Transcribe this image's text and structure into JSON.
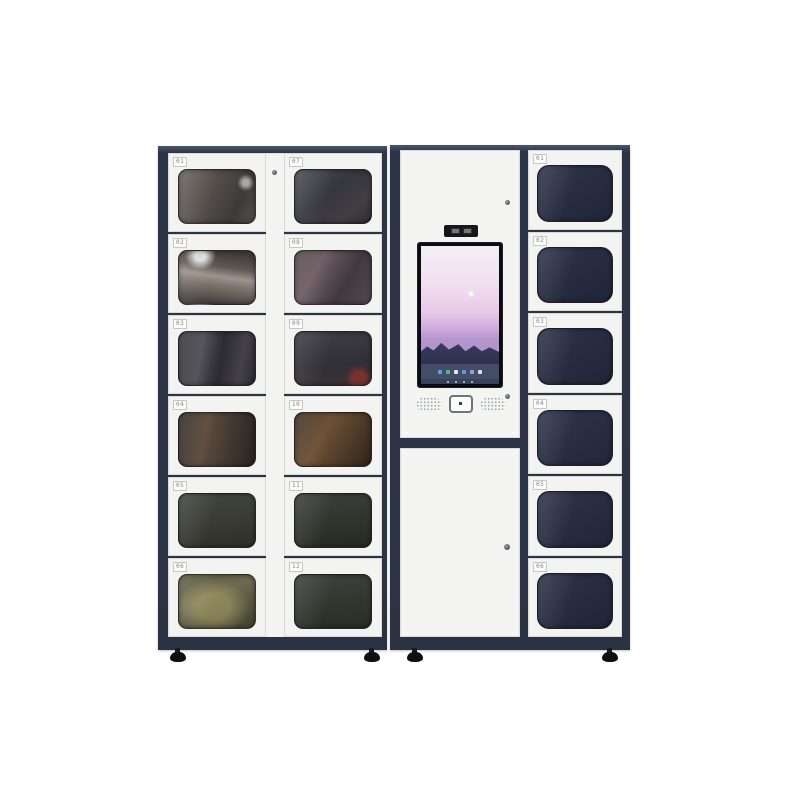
{
  "scene": {
    "description": "Smart locker vending machine: two-column glass-door locker cabinet, central touchscreen kiosk tower, and right locker column",
    "background": "#ffffff"
  },
  "colors": {
    "frame": "#2c3547",
    "frame_edge": "#4a5669",
    "door": "#f3f3f1",
    "door_border": "#d9d9d6",
    "label_text": "#85888e",
    "screen_bezel": "#0b0c10",
    "hardware": "#4b515b"
  },
  "left_unit": {
    "column_a": {
      "lockers": [
        {
          "label": "01",
          "window": "radial-gradient(circle at 88% 24%, rgba(255,255,255,0.55) 0 4%, rgba(255,255,255,0) 11%), linear-gradient(115deg, #6a625e 0%, #524c49 45%, #3d3a38 75%, #57504b 100%)"
        },
        {
          "label": "02",
          "window": "radial-gradient(ellipse at 28% 10%, rgba(255,255,255,0.8) 0 7%, rgba(255,255,255,0) 20%), linear-gradient(8deg, #474340 10%, #7b726d 38%, #9c948c 52%, #5f5753 68%, #403c39 92%)"
        },
        {
          "label": "03",
          "window": "linear-gradient(100deg, #35343a 0%, #504e55 30%, #2c2b31 55%, #45424a 80%, #2a292f 100%)"
        },
        {
          "label": "04",
          "window": "linear-gradient(100deg, #2f2a27 0%, #5d4b3c 35%, #413730 68%, #272321 100%)"
        },
        {
          "label": "05",
          "window": "linear-gradient(175deg, #43453f 0%, #383a33 55%, #2d2f28 100%)"
        },
        {
          "label": "06",
          "window": "radial-gradient(ellipse at 45% 60%, rgba(193,178,112,0.45) 0 28%, rgba(0,0,0,0) 62%), linear-gradient(160deg, #5d5b45 0%, #6b6950 40%, #4e4d38 80%, #434231 100%)"
        }
      ]
    },
    "column_b": {
      "lockers": [
        {
          "label": "07",
          "window": "linear-gradient(140deg, #4c4c56 0%, #36363e 45%, #423e44 75%, #303036 100%)"
        },
        {
          "label": "08",
          "window": "linear-gradient(120deg, #514549 0%, #6d5c62 30%, #413941 65%, #534a50 100%)"
        },
        {
          "label": "09",
          "window": "radial-gradient(circle at 84% 88%, rgba(164,52,40,0.6) 0 8%, rgba(0,0,0,0) 17%), linear-gradient(175deg, #3e3c44 0%, #312f37 60%, #3c3136 100%)"
        },
        {
          "label": "10",
          "window": "linear-gradient(120deg, #3b2d23 0%, #6c5033 38%, #4c3a28 70%, #2f2419 100%)"
        },
        {
          "label": "11",
          "window": "linear-gradient(175deg, #3c3e3a 0%, #31332d 55%, #272922 100%)"
        },
        {
          "label": "12",
          "window": "linear-gradient(175deg, #3e403c 0%, #33352f 55%, #2a2c26 100%)"
        }
      ]
    }
  },
  "kiosk": {
    "camera_module": {
      "slots": 2
    },
    "screen": {
      "sky": "linear-gradient(180deg, #f5eff4 0%, #f0dff0 28%, #e7c9e9 48%, #cfaadd 60%, #b394cd 68%)",
      "sun_color": "#ffffff",
      "mountains": "linear-gradient(180deg, #41446b 0%, #343759 60%, #2e3150 100%)",
      "taskbar_bg": "#434d68",
      "taskbar_icons": [
        "#58a6e0",
        "#43bd8b",
        "#e8eaee",
        "#6296e2",
        "#9aa3b8",
        "#dfe2e8"
      ],
      "navbar_bg": "#38415a",
      "nav_dots": [
        "#c7cdd9",
        "#c7cdd9",
        "#c7cdd9",
        "#c7cdd9"
      ]
    }
  },
  "right_column": {
    "lockers": [
      {
        "label": "01",
        "window": "linear-gradient(150deg, #30354a 0%, #272c41 55%, #21263b 100%)"
      },
      {
        "label": "02",
        "window": "linear-gradient(150deg, #2f3448 0%, #262b3f 55%, #20253a 100%)"
      },
      {
        "label": "03",
        "window": "linear-gradient(150deg, #2e3347 0%, #262b3f 55%, #21263a 100%)"
      },
      {
        "label": "04",
        "window": "linear-gradient(150deg, #30354a 0%, #282d42 55%, #22273c 100%)"
      },
      {
        "label": "05",
        "window": "linear-gradient(150deg, #2f3448 0%, #272c40 55%, #21263b 100%)"
      },
      {
        "label": "06",
        "window": "linear-gradient(150deg, #2e3346 0%, #262b3e 55%, #202539 100%)"
      }
    ]
  }
}
